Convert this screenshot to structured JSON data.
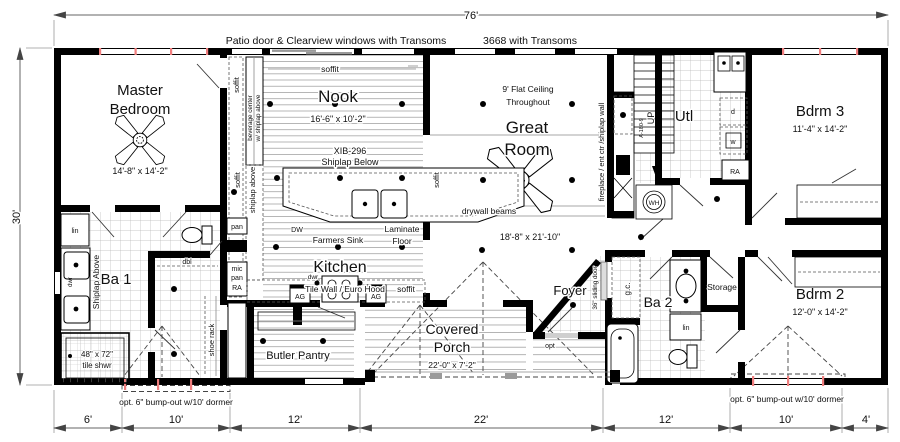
{
  "dimensions": {
    "overall_width": "76'",
    "overall_height": "30'",
    "bottom_segments": [
      "6'",
      "10'",
      "12'",
      "22'",
      "12'",
      "10'",
      "4'"
    ],
    "bump_out_note_left": "opt. 6\" bump-out w/10' dormer",
    "bump_out_note_right": "opt. 6\" bump-out w/10' dormer"
  },
  "wall_notes": {
    "patio": "Patio door & Clearview windows with Transoms",
    "windows_3668": "3668 with Transoms"
  },
  "rooms": {
    "master": {
      "name_line1": "Master",
      "name_line2": "Bedroom",
      "dims": "14'-8\" x 14'-2\""
    },
    "nook": {
      "name": "Nook",
      "dims": "16'-6\" x 10'-2\"",
      "beverage_line1": "beverage center",
      "beverage_line2": "w/ shiplap above"
    },
    "kitchen": {
      "name": "Kitchen",
      "farmers_sink": "Farmers Sink",
      "tile_wall": "Tile Wall / Euro Hood",
      "laminate_line1": "Laminate",
      "laminate_line2": "Floor",
      "island_model": "XIB-296",
      "island_note": "Shiplap Below",
      "shiplap_above": "shiplap above",
      "dw": "DW",
      "dwr": "dwr",
      "pan": "pan",
      "mic": "mic",
      "ra": "RA",
      "ag": "AG"
    },
    "great_room": {
      "name_line1": "Great",
      "name_line2": "Room",
      "dims": "18'-8\" x 21'-10\"",
      "ceiling_line1": "9' Flat Ceiling",
      "ceiling_line2": "Throughout",
      "beams": "drywall beams",
      "fireplace": "fireplace / ent ctr /shiplap wall"
    },
    "ba1": {
      "name": "Ba 1",
      "lin": "lin",
      "dwr": "dwr",
      "shiplap": "Shiplap Above",
      "dbl": "dbl",
      "shoe_rack": "shoe rack",
      "shower_line1": "48\" x 72\"",
      "shower_line2": "tile shwr"
    },
    "closet_hall": {
      "base_cab": "base cab w/ shlvs"
    },
    "butler": {
      "name": "Butler Pantry"
    },
    "porch": {
      "name_line1": "Covered",
      "name_line2": "Porch",
      "dims": "22'-0\" x 7'-2\""
    },
    "foyer": {
      "name": "Foyer",
      "sliding_door": "36\" sliding door",
      "opt": "opt"
    },
    "ba2": {
      "name": "Ba 2",
      "gc": "g.c.",
      "lin": "lin"
    },
    "storage": {
      "name": "Storage"
    },
    "bdrm2": {
      "name": "Bdrm 2",
      "dims": "12'-0\" x 14'-2\""
    },
    "bdrm3": {
      "name": "Bdrm 3",
      "dims": "11'-4\" x 14'-2\""
    },
    "utility": {
      "name": "Utl",
      "dryer": "d",
      "washer": "w",
      "ra": "RA"
    },
    "stairs": {
      "up": "UP",
      "code": "A-180-9",
      "water_heater": "WH"
    }
  },
  "annotations": {
    "soffit": "soffit"
  },
  "colors": {
    "wall": "#000000",
    "window_accent": "#f07e7e",
    "tile_hatch": "#b8b8b8",
    "plank": "#9a9a9a",
    "dim_line": "#666666"
  }
}
